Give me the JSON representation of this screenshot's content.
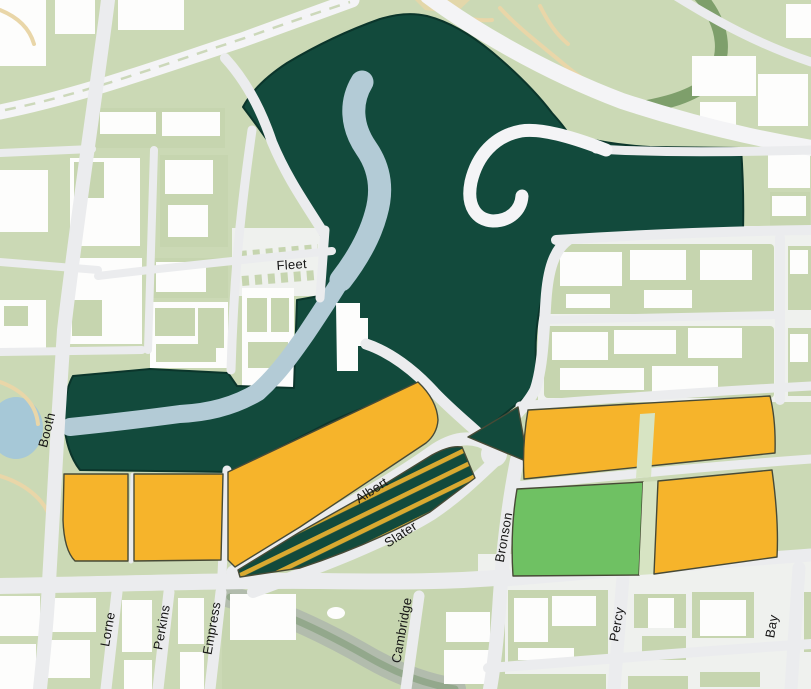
{
  "map": {
    "title": "LeBreton Flats area zoning map",
    "street_labels": [
      {
        "name": "Fleet"
      },
      {
        "name": "Booth"
      },
      {
        "name": "Lorne"
      },
      {
        "name": "Perkins"
      },
      {
        "name": "Empress"
      },
      {
        "name": "Albert"
      },
      {
        "name": "Slater"
      },
      {
        "name": "Cambridge"
      },
      {
        "name": "Bronson"
      },
      {
        "name": "Percy"
      },
      {
        "name": "Bay"
      }
    ],
    "colors": {
      "dark_green": "#124A3C",
      "parcel_orange": "#F6B42B",
      "stripe_yellow": "#D9A930",
      "parcel_green": "#6FC163",
      "divider_green": "#D7E4C3",
      "park_green": "#CBD9B5",
      "block_green": "#C6D5AF",
      "road": "#EBECEE",
      "road_bright": "#F4F4F6",
      "building_white": "#FDFDFC",
      "water": "#B3CBD6",
      "pond": "#A6C8D7",
      "escarpment": "#7E9F6B",
      "creek": "#B2BCAD",
      "path_beige": "#E9D6A8",
      "urban_bg": "#EFF1EE",
      "outline_dark": "#0B352B",
      "parcel_outline": "#474A36",
      "label_color": "#151515"
    }
  }
}
